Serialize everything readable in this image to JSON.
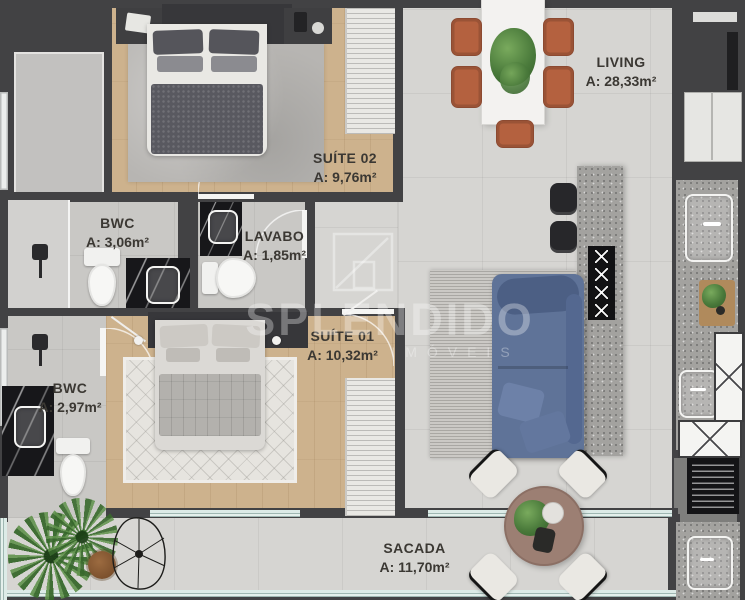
{
  "watermark": {
    "brand": "SPLENDIDO",
    "tagline": "IMÓVEIS"
  },
  "rooms": {
    "suite02": {
      "label": "SUÍTE 02",
      "area": "A: 9,76m²"
    },
    "living": {
      "label": "LIVING",
      "area": "A: 28,33m²"
    },
    "bwc1": {
      "label": "BWC",
      "area": "A: 3,06m²"
    },
    "lavabo": {
      "label": "LAVABO",
      "area": "A: 1,85m²"
    },
    "suite01": {
      "label": "SUÍTE 01",
      "area": "A: 10,32m²"
    },
    "bwc2": {
      "label": "BWC",
      "area": "A: 2,97m²"
    },
    "sacada": {
      "label": "SACADA",
      "area": "A: 11,70m²"
    }
  },
  "theme": {
    "wall": "#424244",
    "tile": "#d6d5d2",
    "tile-dim": "#c9c8c5",
    "wood": "#cdb28d",
    "label": "#3b3833",
    "sofa": "#5f7398",
    "chair": "#b4613f",
    "island": "#a3a29f",
    "marble": "#17171a",
    "plant": "#4a7a3b",
    "balcony-table": "#9c7f73",
    "glass": "#bcd6d0",
    "watermark": "rgba(255,255,255,0.32)"
  }
}
